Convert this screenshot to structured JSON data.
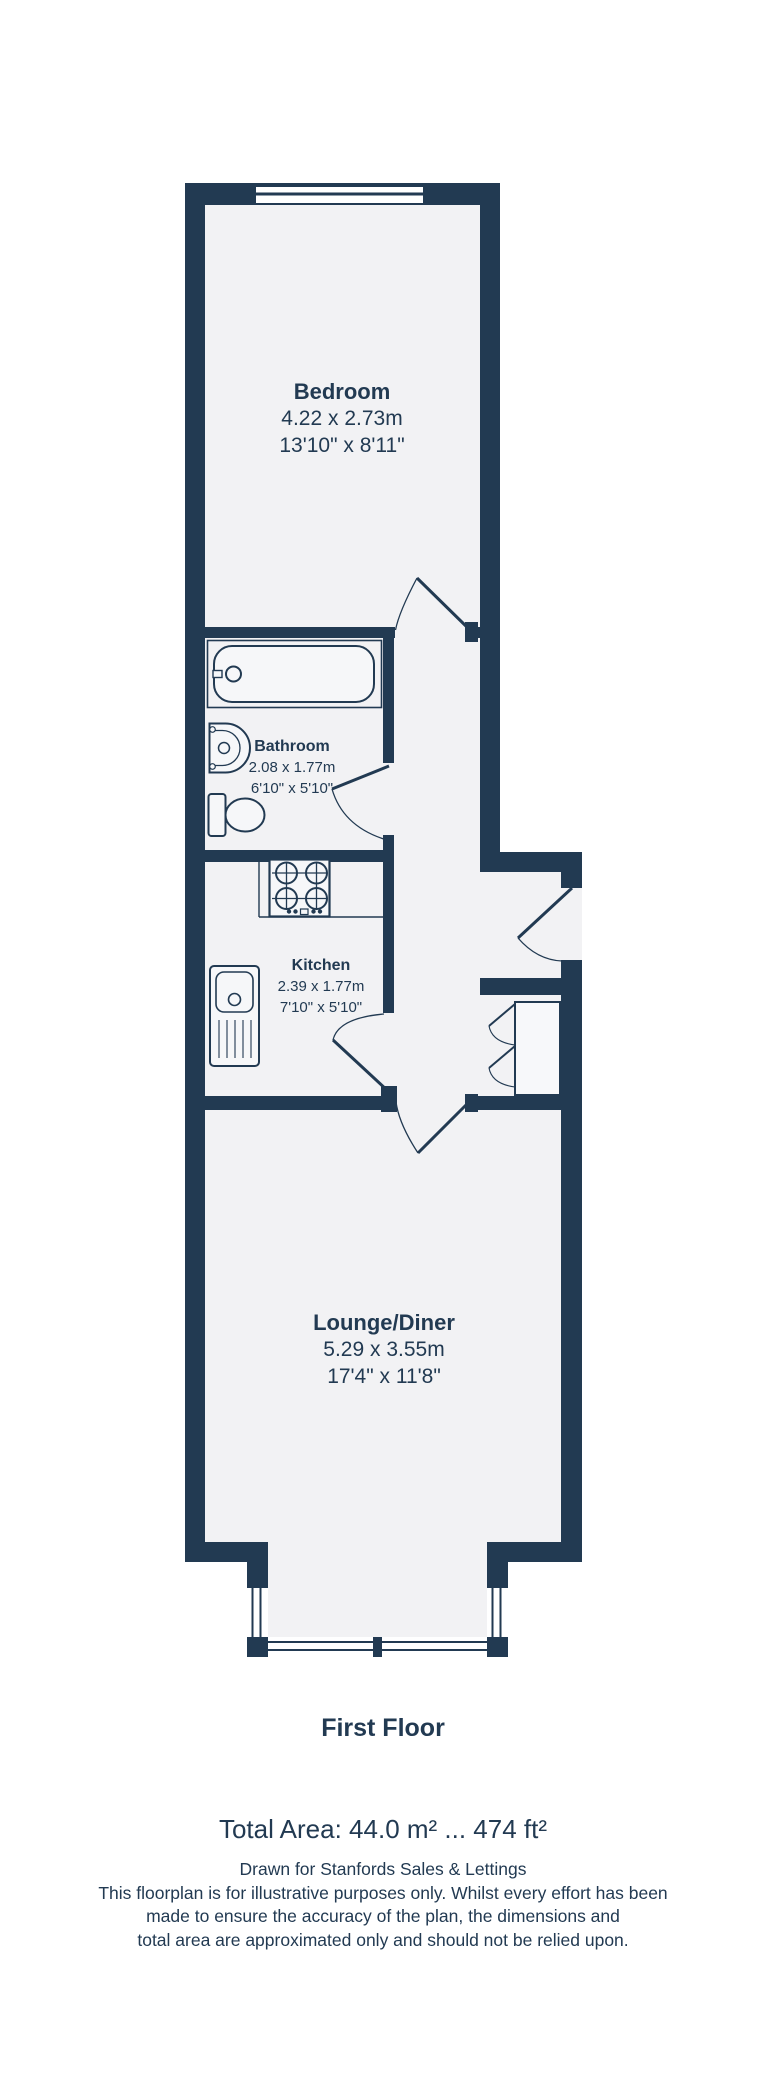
{
  "colors": {
    "wall": "#223a52",
    "floor": "#f2f2f4",
    "fixture_fill": "#f6f7f9",
    "text": "#223a52",
    "background": "#ffffff"
  },
  "rooms": {
    "bedroom": {
      "name": "Bedroom",
      "metric": "4.22 x 2.73m",
      "imperial": "13'10\" x 8'11\""
    },
    "bathroom": {
      "name": "Bathroom",
      "metric": "2.08 x 1.77m",
      "imperial": "6'10\" x 5'10\""
    },
    "kitchen": {
      "name": "Kitchen",
      "metric": "2.39 x 1.77m",
      "imperial": "7'10\" x 5'10\""
    },
    "lounge": {
      "name": "Lounge/Diner",
      "metric": "5.29 x 3.55m",
      "imperial": "17'4\" x 11'8\""
    }
  },
  "footer": {
    "floor_title": "First Floor",
    "total_area": "Total Area: 44.0 m² ... 474 ft²",
    "disclaimer_lines": [
      "Drawn for Stanfords Sales & Lettings",
      "This floorplan is for illustrative purposes only. Whilst every effort has been",
      "made to ensure the accuracy of the plan, the dimensions and",
      "total area are approximated only and should not be relied upon."
    ]
  }
}
